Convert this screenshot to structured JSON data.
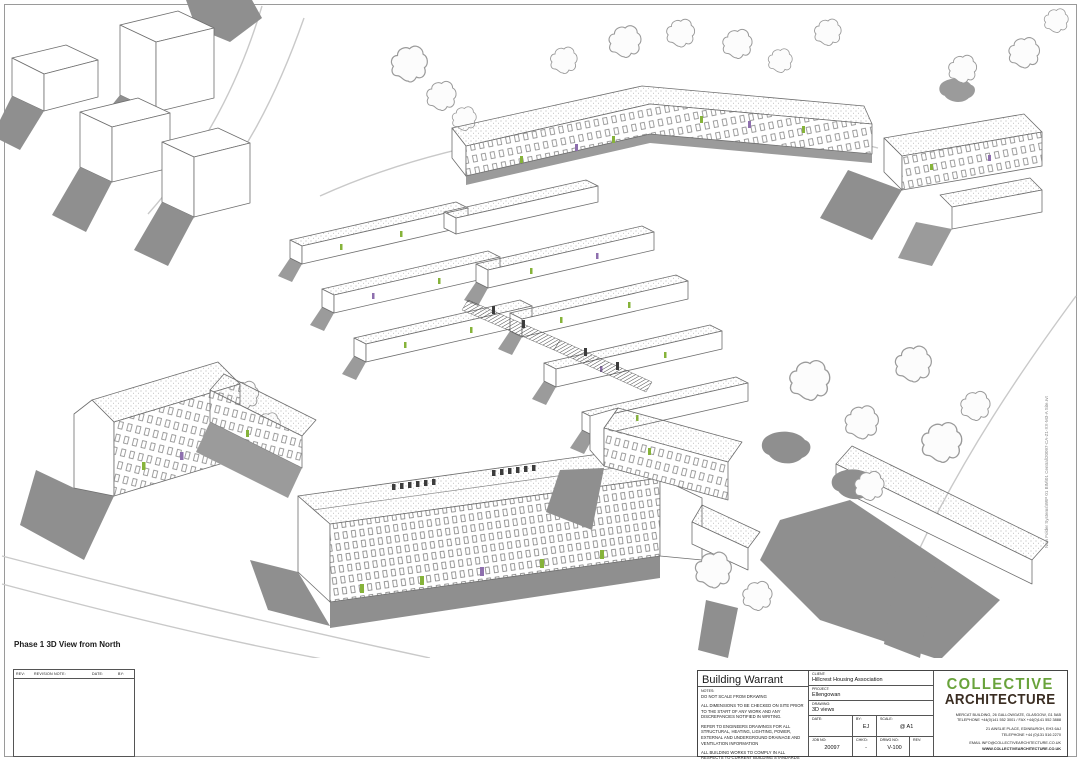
{
  "sheet": {
    "caption": "Phase 1 3D View from North",
    "stamp_text": "New Folder Systems\\WIP 01 BIM\\01 Central\\20097-CA-Z1-XX-M3-A Site.rvt"
  },
  "revision_table": {
    "headers": {
      "rev": "REV:",
      "note": "REVISION NOTE:",
      "date": "DATE:",
      "by": "BY:"
    }
  },
  "title_block": {
    "title": "Building Warrant",
    "notes_label": "NOTES:",
    "notes": [
      "DO NOT SCALE FROM DRAWING",
      "ALL DIMENSIONS TO BE CHECKED ON SITE PRIOR TO THE START OF ANY WORK AND ANY DISCREPANCIES NOTIFIED IN WRITING.",
      "REFER TO ENGINEERS DRAWINGS FOR ALL STRUCTURAL, HEATING, LIGHTING, POWER, EXTERNAL AND UNDERGROUND DRAINAGE AND VENTILATION INFORMATION",
      "ALL BUILDING WORKS TO COMPLY IN ALL RESPECTS TO CURRENT BUILDING STANDARDS FOR COUNTRY IN WHICH SITE IS LOCATED."
    ],
    "fields": {
      "client_label": "CLIENT:",
      "client": "Hillcrest Housing Association",
      "project_label": "PROJECT:",
      "project": "Ellengowan",
      "drawing_label": "DRAWING:",
      "drawing": "3D views",
      "date_label": "DATE:",
      "date": "",
      "by_label": "BY:",
      "by": "EJ",
      "scale_label": "SCALE:",
      "scale": "@ A1",
      "job_label": "JOB NO:",
      "job": "20097",
      "chkd_label": "CHK'D:",
      "chkd": "-",
      "drwg_label": "DRWG NO:",
      "drwg": "V-100",
      "rev_label": "REV:",
      "rev": ""
    },
    "firm": {
      "name_line1": "COLLECTIVE",
      "name_line2": "ARCHITECTURE",
      "brand_green": "#69a33b",
      "brand_dark": "#3a2d22",
      "address_lines": [
        "MERCAT BUILDING, 26 GALLOWGATE, GLASGOW, G1 5AB",
        "TELEPHONE +44(0)141 552 3001 / FAX +44(0)141 552 3888",
        "21 AINSLIE PLACE, EDINBURGH, EH3 6AJ",
        "TELEPHONE +44 (0)131 516 2270",
        "EMAIL INFO@COLLECTIVEARCHITECTURE.CO.UK",
        "WWW.COLLECTIVEARCHITECTURE.CO.UK"
      ]
    }
  }
}
